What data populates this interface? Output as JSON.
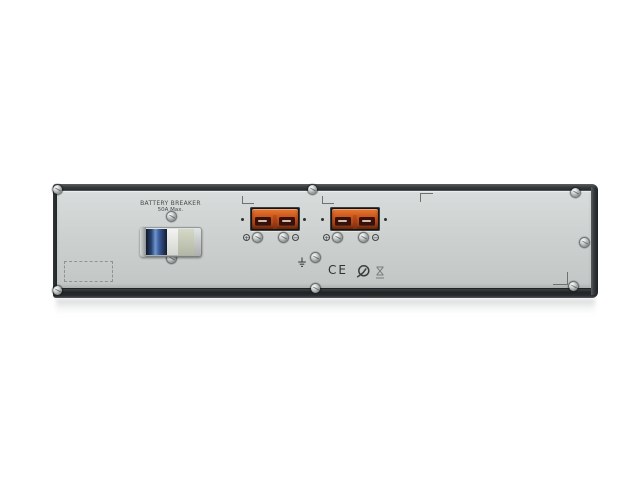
{
  "scene": {
    "type": "product-photo",
    "subject": "Rack-mount UPS external battery pack, rear panel, 2U",
    "background_color": "#ffffff"
  },
  "panel": {
    "breaker": {
      "title": "BATTERY BREAKER",
      "rating": "50A Max."
    },
    "connectors": [
      {
        "name": "battery-connector-1",
        "polarity_left": "+",
        "polarity_right": "−"
      },
      {
        "name": "battery-connector-2",
        "polarity_left": "+",
        "polarity_right": "−"
      }
    ],
    "certifications": {
      "ce_label": "CE",
      "marks": [
        "c-tick-mark",
        "hourglass-cert-mark"
      ]
    },
    "icons": {
      "ground": "earth-ground-icon",
      "screw": "philips-screw-icon",
      "label_placeholder": "dashed-outline-box"
    },
    "colors": {
      "chassis_frame": "#2e3234",
      "panel_face": "#cbcfce",
      "connector_orange": "#c2511d",
      "connector_recess": "#161514",
      "breaker_blue": "#3d5c9d",
      "label_text": "#474c4b"
    }
  }
}
